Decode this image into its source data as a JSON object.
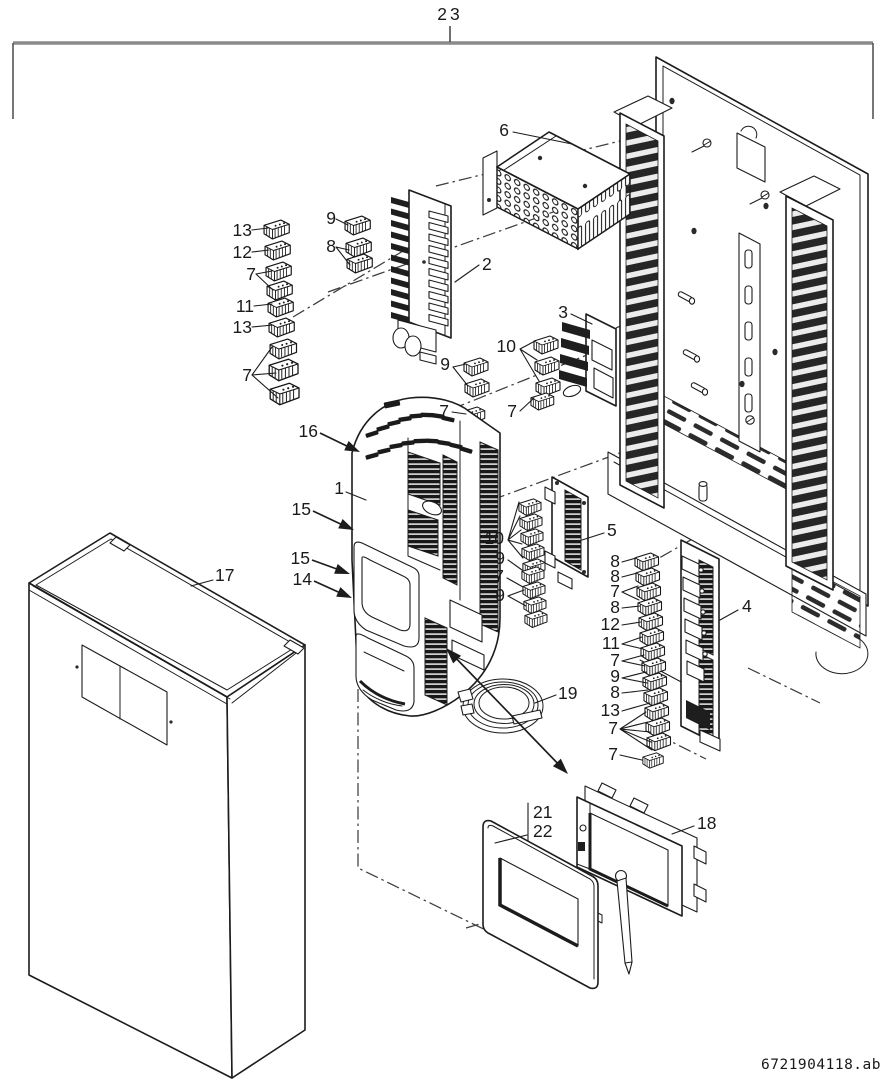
{
  "figure": {
    "part_code": "6721904118.ab"
  },
  "callouts": {
    "c23": "23",
    "c13a": "13",
    "c12a": "12",
    "c7a": "7",
    "c11a": "11",
    "c13b": "13",
    "c7b": "7",
    "c9a": "9",
    "c8a": "8",
    "c2": "2",
    "c6": "6",
    "c3": "3",
    "c10a": "10",
    "c9b": "9",
    "c7c": "7",
    "c7d": "7",
    "c16": "16",
    "c1": "1",
    "c15a": "15",
    "c15b": "15",
    "c14": "14",
    "c17": "17",
    "c5": "5",
    "c10b": "10",
    "c9c": "9",
    "c7e": "7",
    "c9d": "9",
    "c4": "4",
    "c8b": "8",
    "c8c": "8",
    "c7f": "7",
    "c8d": "8",
    "c12b": "12",
    "c11b": "11",
    "c7g": "7",
    "c9e": "9",
    "c8e": "8",
    "c13c": "13",
    "c7h": "7",
    "c7i": "7",
    "c19": "19",
    "c21": "21",
    "c22": "22",
    "c18": "18"
  }
}
